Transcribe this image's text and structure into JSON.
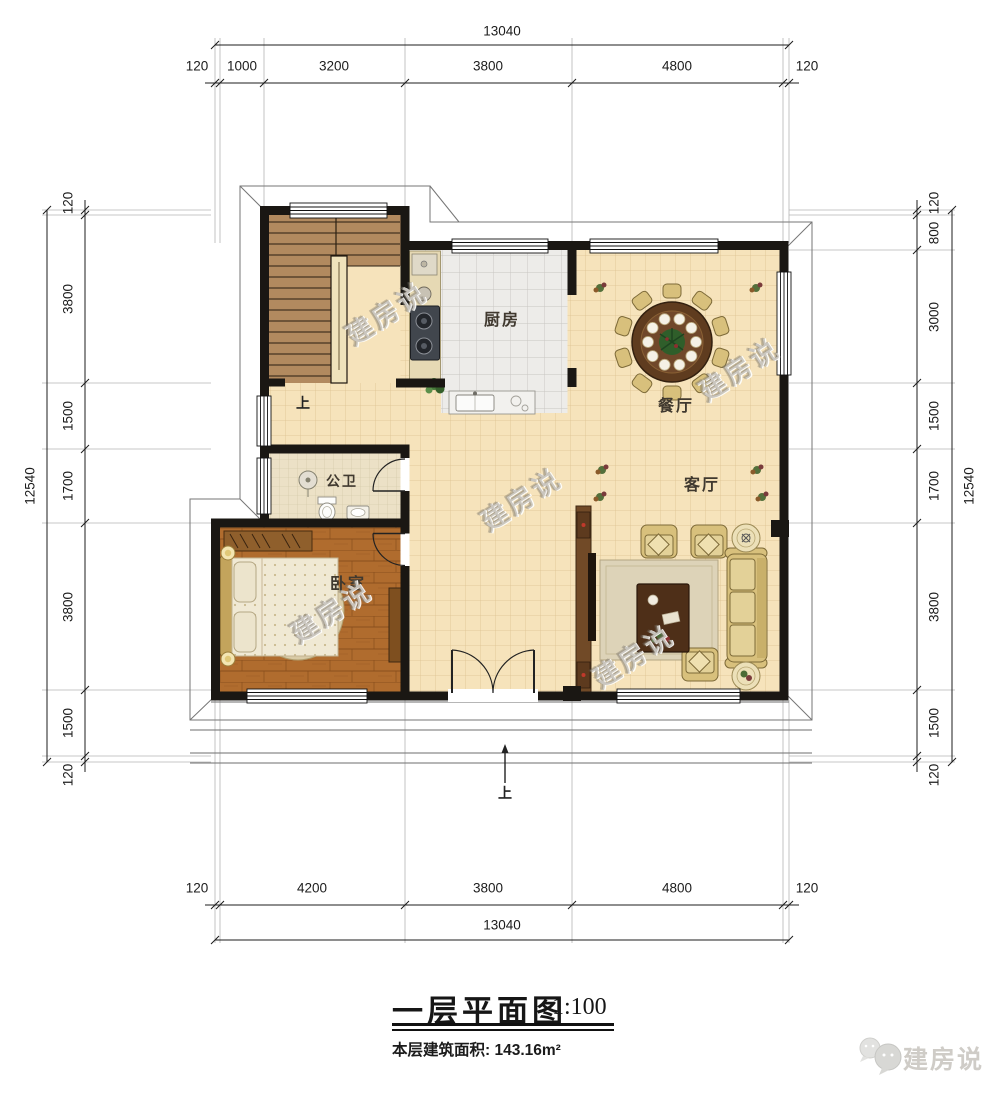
{
  "title": {
    "text": "一层平面图",
    "scale": "1:100",
    "area_note": "本层建筑面积: 143.16m²"
  },
  "rooms": {
    "kitchen": "厨房",
    "dining": "餐厅",
    "living": "客厅",
    "bathroom": "公卫",
    "bedroom": "卧室"
  },
  "labels": {
    "stairs_up": "上",
    "entry_up": "上"
  },
  "watermark": {
    "text": "建房说"
  },
  "brand": {
    "name": "建房说"
  },
  "dimensions": {
    "top": {
      "total": "13040",
      "segments": [
        "120",
        "1000",
        "3200",
        "3800",
        "4800",
        "120"
      ]
    },
    "bottom": {
      "total": "13040",
      "segments": [
        "120",
        "4200",
        "3800",
        "4800",
        "120"
      ]
    },
    "left": {
      "total": "12540",
      "segments": [
        "120",
        "3800",
        "1500",
        "1700",
        "3800",
        "1500",
        "120"
      ]
    },
    "right": {
      "total": "12540",
      "segments": [
        "120",
        "800",
        "3000",
        "1500",
        "1700",
        "3800",
        "1500",
        "120"
      ]
    }
  },
  "palette": {
    "wall": "#1a1713",
    "floor_tile": "#f6e3bb",
    "kitchen_tile": "#edece9",
    "bath_tile": "#ece1c6",
    "wood_floor": "#b06c2e",
    "furniture_tan": "#d9c17f",
    "furniture_wood": "#5c3a1d"
  }
}
